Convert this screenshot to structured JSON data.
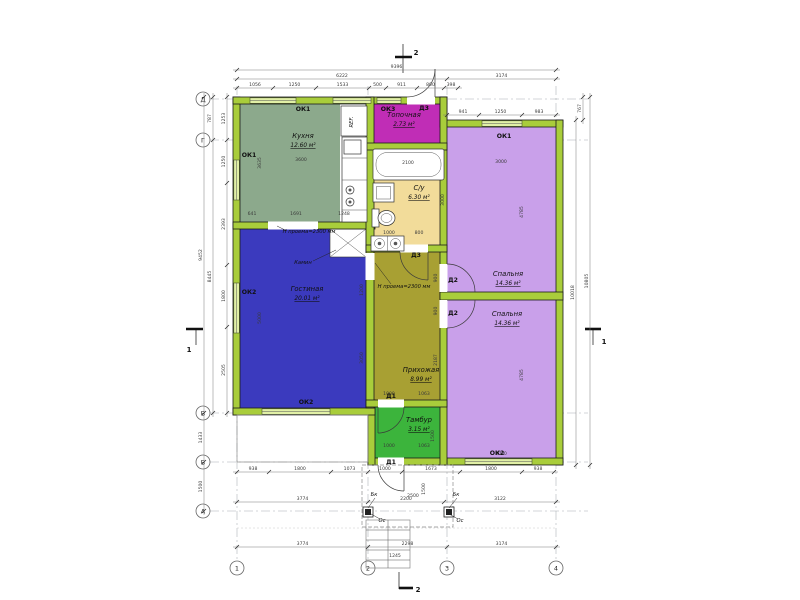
{
  "palette": {
    "wall": "#a9cd3b",
    "window": "#e1f0a6",
    "kitchen": "#8ca98c",
    "boiler": "#c02db6",
    "bath": "#f2dc9a",
    "living": "#3b3abe",
    "hall": "#a8a033",
    "tambour": "#3cb43c",
    "bedroom": "#c9a0ea"
  },
  "sections": {
    "top": "2",
    "bottom": "2",
    "left": "1",
    "right": "1"
  },
  "axes": {
    "cols": [
      {
        "label": "1",
        "x": 237
      },
      {
        "label": "2",
        "x": 368
      },
      {
        "label": "3",
        "x": 447
      },
      {
        "label": "4",
        "x": 556
      }
    ],
    "rows": [
      {
        "label": "А",
        "y": 511
      },
      {
        "label": "Б",
        "y": 462
      },
      {
        "label": "В",
        "y": 413
      },
      {
        "label": "Г",
        "y": 140
      },
      {
        "label": "Д",
        "y": 99
      }
    ],
    "col_line": {
      "y1": 86,
      "y2": 560,
      "circle_y": 568
    },
    "row_line": {
      "x1": 210,
      "x2": 588,
      "circle_x": 203
    },
    "radius": 7
  },
  "rooms": [
    {
      "name": "Кухня",
      "area": "12.60 м²",
      "cx": 303,
      "cy": 138
    },
    {
      "name": "Топочная",
      "area": "2.73 м²",
      "cx": 404,
      "cy": 117
    },
    {
      "name": "С/у",
      "area": "6.30 м²",
      "cx": 419,
      "cy": 190
    },
    {
      "name": "Гостиная",
      "area": "20.01 м²",
      "cx": 307,
      "cy": 291
    },
    {
      "name": "Прихожая",
      "area": "8.99 м²",
      "cx": 421,
      "cy": 372
    },
    {
      "name": "Тамбур",
      "area": "3.15 м²",
      "cx": 419,
      "cy": 422
    },
    {
      "name": "Спальня",
      "area": "14.36 м²",
      "cx": 508,
      "cy": 276
    },
    {
      "name": "Спальня",
      "area": "14.36 м²",
      "cx": 507,
      "cy": 316
    }
  ],
  "feature_labels": [
    {
      "t": "ОК1",
      "x": 303,
      "y": 111
    },
    {
      "t": "ОК3",
      "x": 388,
      "y": 111
    },
    {
      "t": "Д3",
      "x": 424,
      "y": 110
    },
    {
      "t": "ОК1",
      "x": 249,
      "y": 157
    },
    {
      "t": "ОК1",
      "x": 504,
      "y": 138
    },
    {
      "t": "ОК2",
      "x": 249,
      "y": 294
    },
    {
      "t": "ОК2",
      "x": 306,
      "y": 404
    },
    {
      "t": "ОК2",
      "x": 497,
      "y": 455
    },
    {
      "t": "Д1",
      "x": 391,
      "y": 398
    },
    {
      "t": "Д1",
      "x": 391,
      "y": 464
    },
    {
      "t": "Д2",
      "x": 453,
      "y": 282
    },
    {
      "t": "Д2",
      "x": 453,
      "y": 315
    },
    {
      "t": "Д3",
      "x": 416,
      "y": 257
    }
  ],
  "annotations": [
    {
      "t": "Камин",
      "x": 303,
      "y": 264
    },
    {
      "t": "REF.",
      "x": 353,
      "y": 122,
      "r": -90,
      "s": 4.8
    },
    {
      "t": "Н проема=2300 мм",
      "x": 309,
      "y": 233
    },
    {
      "t": "Н проема=2300 мм",
      "x": 404,
      "y": 288
    },
    {
      "t": "Бк",
      "x": 374,
      "y": 496
    },
    {
      "t": "Бк",
      "x": 456,
      "y": 496
    },
    {
      "t": "Ос",
      "x": 382,
      "y": 522
    },
    {
      "t": "Ос",
      "x": 460,
      "y": 522
    }
  ],
  "dims": {
    "h_rows": [
      {
        "y": 70,
        "pts": [
          237,
          556
        ],
        "labels": [
          "9396"
        ]
      },
      {
        "y": 79,
        "pts": [
          237,
          447,
          556
        ],
        "labels": [
          "6222",
          "3174"
        ]
      },
      {
        "y": 88,
        "pts": [
          237,
          273,
          316,
          369,
          386,
          417,
          444,
          458
        ],
        "labels": [
          "1056",
          "1250",
          "1533",
          "500",
          "911",
          "800",
          "398"
        ]
      },
      {
        "y": 115,
        "pts": [
          447,
          479,
          522,
          556
        ],
        "labels": [
          "941",
          "1250",
          "983"
        ]
      },
      {
        "y": 472,
        "pts": [
          237,
          269,
          331,
          368,
          402,
          460,
          522,
          554
        ],
        "labels": [
          "938",
          "1800",
          "1073",
          "1000",
          "1673",
          "1800",
          "938"
        ]
      },
      {
        "y": 502,
        "pts": [
          237,
          368,
          444,
          556
        ],
        "labels": [
          "3774",
          "2200",
          "3122"
        ]
      },
      {
        "y": 547,
        "pts": [
          237,
          368,
          447,
          556
        ],
        "labels": [
          "3774",
          "2298",
          "3174"
        ]
      }
    ],
    "v_cols": [
      {
        "x": 204,
        "pts": [
          97,
          413,
          462,
          511
        ],
        "labels": [
          "9452",
          "1433",
          "1500"
        ]
      },
      {
        "x": 213,
        "pts": [
          97,
          140,
          413
        ],
        "labels": [
          "787",
          "8445"
        ]
      },
      {
        "x": 227,
        "pts": [
          97,
          140,
          183,
          265,
          327,
          413
        ],
        "labels": [
          "1253",
          "1250",
          "2393",
          "1800",
          "2505"
        ]
      },
      {
        "x": 576,
        "pts": [
          120,
          465
        ],
        "labels": [
          "10018"
        ]
      },
      {
        "x": 583,
        "pts": [
          97,
          120
        ],
        "labels": [
          "767"
        ]
      },
      {
        "x": 590,
        "pts": [
          97,
          465
        ],
        "labels": [
          "10805"
        ]
      }
    ],
    "free": [
      {
        "t": "3600",
        "x": 301,
        "y": 161
      },
      {
        "t": "3635",
        "x": 261,
        "y": 163,
        "r": -90
      },
      {
        "t": "641",
        "x": 252,
        "y": 215
      },
      {
        "t": "1691",
        "x": 296,
        "y": 215
      },
      {
        "t": "1248",
        "x": 344,
        "y": 215
      },
      {
        "t": "5000",
        "x": 261,
        "y": 318,
        "r": -90
      },
      {
        "t": "1200",
        "x": 363,
        "y": 290,
        "r": -90
      },
      {
        "t": "3050",
        "x": 363,
        "y": 358,
        "r": -90
      },
      {
        "t": "3000",
        "x": 501,
        "y": 163
      },
      {
        "t": "4785",
        "x": 523,
        "y": 212,
        "r": -90
      },
      {
        "t": "4785",
        "x": 523,
        "y": 375,
        "r": -90
      },
      {
        "t": "3000",
        "x": 501,
        "y": 455
      },
      {
        "t": "1000",
        "x": 389,
        "y": 234
      },
      {
        "t": "800",
        "x": 419,
        "y": 234
      },
      {
        "t": "3000",
        "x": 444,
        "y": 200,
        "r": -90
      },
      {
        "t": "900",
        "x": 437,
        "y": 278,
        "r": -90
      },
      {
        "t": "900",
        "x": 437,
        "y": 311,
        "r": -90
      },
      {
        "t": "2187",
        "x": 437,
        "y": 360,
        "r": -90
      },
      {
        "t": "1000",
        "x": 389,
        "y": 395
      },
      {
        "t": "1063",
        "x": 424,
        "y": 395
      },
      {
        "t": "1000",
        "x": 389,
        "y": 447
      },
      {
        "t": "1063",
        "x": 424,
        "y": 447
      },
      {
        "t": "1500",
        "x": 434,
        "y": 436,
        "r": -90
      },
      {
        "t": "2500",
        "x": 413,
        "y": 497
      },
      {
        "t": "1500",
        "x": 425,
        "y": 489,
        "r": -90
      },
      {
        "t": "1245",
        "x": 395,
        "y": 557
      },
      {
        "t": "2100",
        "x": 408,
        "y": 164
      }
    ]
  }
}
